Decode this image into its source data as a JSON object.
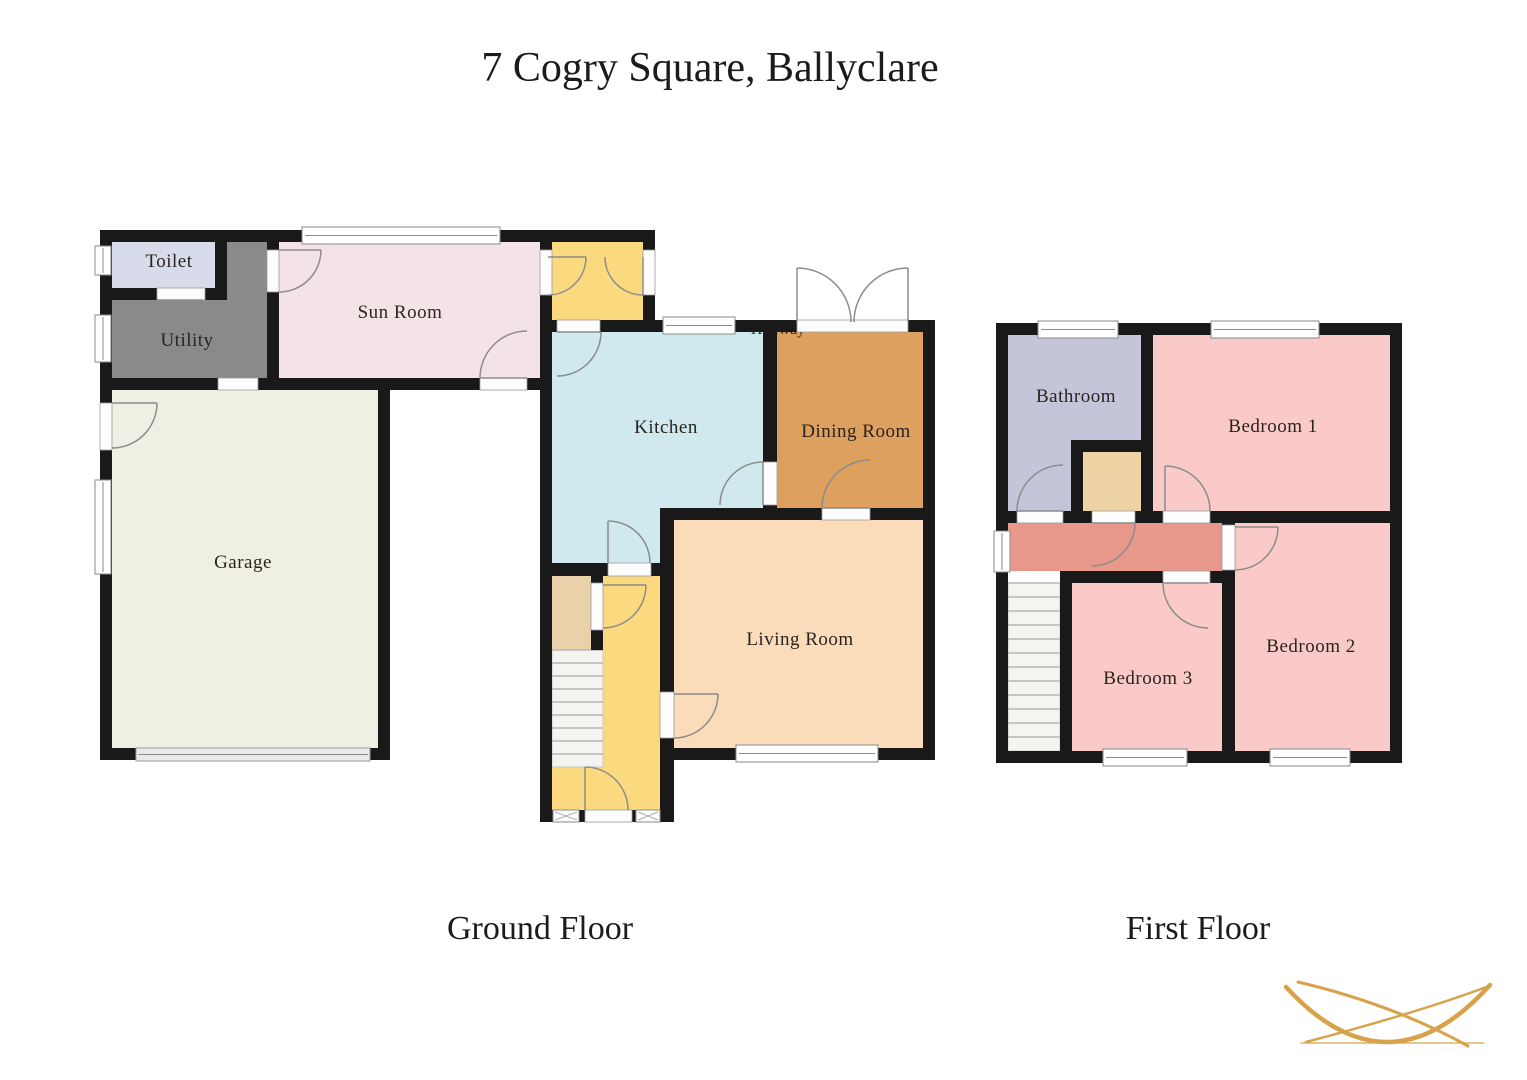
{
  "title": "7 Cogry Square, Ballyclare",
  "floors": {
    "ground": {
      "label": "Ground Floor",
      "rooms": {
        "toilet": {
          "label": "Toilet",
          "color": "#d8dbea"
        },
        "utility": {
          "label": "Utility",
          "color": "#8a8a8a"
        },
        "sun_room": {
          "label": "Sun Room",
          "color": "#f3e3e7"
        },
        "garage": {
          "label": "Garage",
          "color": "#f0efe3"
        },
        "kitchen": {
          "label": "Kitchen",
          "color": "#cfe9ee"
        },
        "dining_room": {
          "label": "Dining Room",
          "color": "#dea05f"
        },
        "living_room": {
          "label": "Living Room",
          "color": "#fbdcba"
        },
        "hallway": {
          "label": "Hallway",
          "color": "#fbd97e"
        },
        "porch": {
          "color": "#fbd97e"
        },
        "stairs_cupboard": {
          "color": "#e9d1a9"
        }
      }
    },
    "first": {
      "label": "First Floor",
      "rooms": {
        "bathroom": {
          "label": "Bathroom",
          "color": "#c5c5da"
        },
        "bedroom_1": {
          "label": "Bedroom 1",
          "color": "#f9cac8"
        },
        "bedroom_2": {
          "label": "Bedroom 2",
          "color": "#f9cac8"
        },
        "bedroom_3": {
          "label": "Bedroom 3",
          "color": "#f9cac8"
        },
        "landing": {
          "color": "#e8988b"
        },
        "airing_cupboard": {
          "color": "#eed4a4"
        }
      }
    }
  },
  "logo": {
    "color": "#d8a24b"
  }
}
